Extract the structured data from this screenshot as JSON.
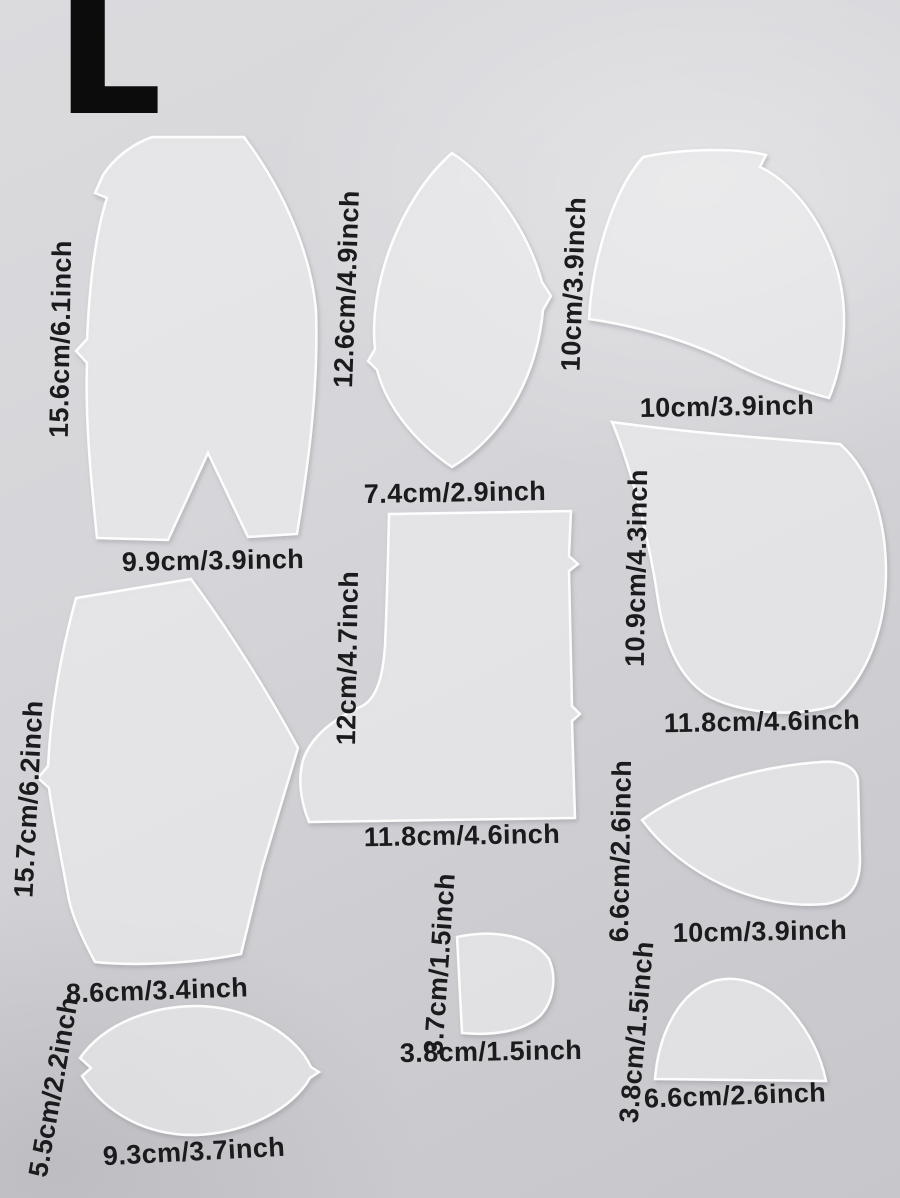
{
  "photo": {
    "size_label": "L",
    "surface_color": "#d2d2d6",
    "label_color": "#1b1b1d",
    "piece_color": "rgba(255,255,255,0.52)"
  },
  "pieces": [
    {
      "name": "front-upper-panel",
      "height_label": "15.6cm/6.1inch",
      "width_label": "9.9cm/3.9inch"
    },
    {
      "name": "vamp-leaf-panel",
      "height_label": "12.6cm/4.9inch",
      "width_label": "7.4cm/2.9inch"
    },
    {
      "name": "quarter-wave-panel",
      "height_label": "10cm/3.9inch",
      "width_label": "10cm/3.9inch"
    },
    {
      "name": "side-curve-panel",
      "height_label": "10.9cm/4.3inch",
      "width_label": "11.8cm/4.6inch"
    },
    {
      "name": "boot-shaft-panel",
      "height_label": "12cm/4.7inch",
      "width_label": "11.8cm/4.6inch"
    },
    {
      "name": "back-panel",
      "height_label": "15.7cm/6.2inch",
      "width_label": "8.6cm/3.4inch"
    },
    {
      "name": "tongue-panel",
      "height_label": "6.6cm/2.6inch",
      "width_label": "10cm/3.9inch"
    },
    {
      "name": "sole-oval-panel",
      "height_label": "5.5cm/2.2inch",
      "width_label": "9.3cm/3.7inch"
    },
    {
      "name": "heel-tab-panel",
      "height_label": "3.7cm/1.5inch",
      "width_label": "3.8cm/1.5inch"
    },
    {
      "name": "toe-dome-panel",
      "height_label": "3.8cm/1.5inch",
      "width_label": "6.6cm/2.6inch"
    }
  ]
}
